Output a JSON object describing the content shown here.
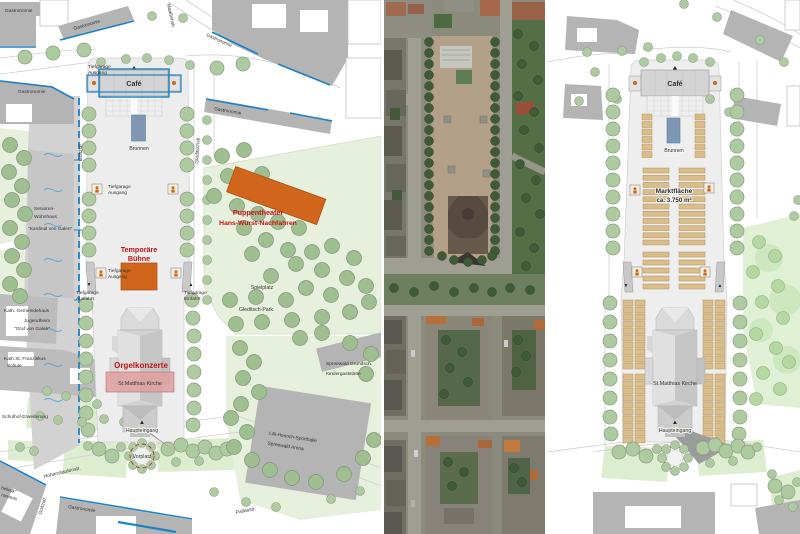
{
  "plan_events": {
    "cafe": "Café",
    "brunnen": "Brunnen",
    "tiefgarage": "Tiefgarage",
    "ausgang": "Ausgang",
    "ausfahrt": "Ausfahrt",
    "einfahrt": "Einfahrt",
    "buehne_line1": "Temporäre",
    "buehne_line2": "Bühne",
    "orgelkonzerte": "Orgelkonzerte",
    "kirche": "St.Matthias Kirche",
    "haupteingang": "Haupteingang",
    "vorplatz": "Vorplatz",
    "puppentheater_line1": "Puppentheater",
    "puppentheater_line2": "Hans-Wurst-Nachfahren",
    "spielplatz": "Spielplatz",
    "gleditsch_park": "Gleditsch-Park",
    "gastronomie": "Gastronomie",
    "gastronomie_partial": "ronomie",
    "building_name_partial": "helleck\"",
    "senioren_line1": "Senioren-",
    "senioren_line2": "Wohnhaus",
    "senioren_line3": "\"Kardinal von Galen\"",
    "gemeindehaus": "Kath. Gemeindehaus",
    "jugendheim_line1": "Jugendheim",
    "jugendheim_line2": "\"Graf von Galen\"",
    "schule_line1": "Kath.St. Franziskus",
    "schule_line2": "Schule",
    "schulhof": "Schulhof-Erweiterung",
    "grundschule": "Spreewald Grundsch.",
    "kindergaststaette": "Kindergaststätte",
    "sporthalle_line1": "Lilli-Henoch-Sporthalle",
    "sporthalle_line2": "Spreewald Arena",
    "streets": {
      "maassenstr": "Maaßenstr.",
      "goltzstr": "Goltzstr.",
      "gleditschstr": "Gleditschstr.",
      "hohenstaufenstr": "Hohenstaufenstr.",
      "pallasstr": "Pallasstr."
    },
    "symbols": {
      "down_arrow": "▼",
      "up_arrow": "▲"
    }
  },
  "plan_market": {
    "cafe": "Café",
    "brunnen": "Brunnen",
    "marktflaeche_line1": "Marktfläche",
    "marktflaeche_line2": "ca. 3.750 m²",
    "kirche": "St.Matthias Kirche",
    "haupteingang": "Haupteingang",
    "symbols": {
      "down_arrow": "▼",
      "up_arrow": "▲"
    }
  },
  "colors": {
    "accent_blue": "#1e82c4",
    "label_red": "#c41111",
    "stage_orange": "#d2651c",
    "fountain_blue": "#7e97b2",
    "stall_tan": "#d9bd8a",
    "building_gray": "#b4b4b4",
    "park_green": "#e7f0dd",
    "tree_green": "#aecaa0",
    "church_overlay_pink": "#dfa0a0"
  }
}
